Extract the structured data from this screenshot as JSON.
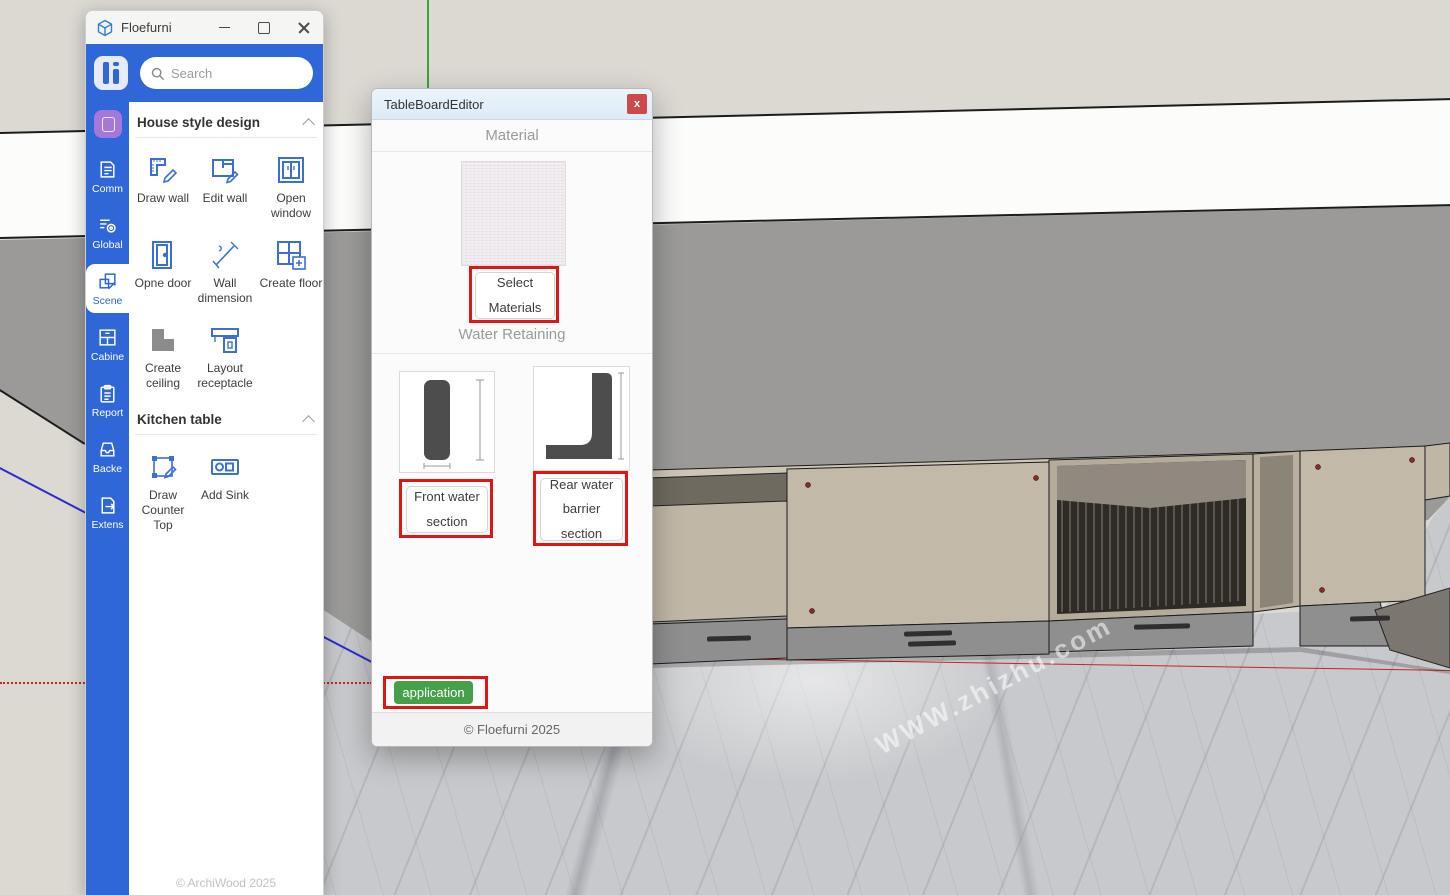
{
  "host_window": {
    "title": "Floefurni",
    "search_placeholder": "Search",
    "footer": "© ArchiWood 2025"
  },
  "rail": {
    "selected": "Scene",
    "items": [
      {
        "label": "Comm"
      },
      {
        "label": "Global"
      },
      {
        "label": "Scene"
      },
      {
        "label": "Cabine"
      },
      {
        "label": "Report"
      },
      {
        "label": "Backe"
      },
      {
        "label": "Extens"
      }
    ]
  },
  "panel": {
    "sections": [
      {
        "title": "House style design",
        "tools": [
          {
            "label": "Draw wall"
          },
          {
            "label": "Edit wall"
          },
          {
            "label": "Open window"
          },
          {
            "label": "Opne door"
          },
          {
            "label": "Wall dimension"
          },
          {
            "label": "Create floor"
          },
          {
            "label": "Create ceiling"
          },
          {
            "label": "Layout receptacle"
          }
        ]
      },
      {
        "title": "Kitchen table",
        "tools": [
          {
            "label": "Draw Counter Top"
          },
          {
            "label": "Add Sink"
          }
        ]
      }
    ]
  },
  "dialog": {
    "title": "TableBoardEditor",
    "close_label": "x",
    "material_heading": "Material",
    "select_materials_label": "Select\nMaterials",
    "water_heading": "Water Retaining",
    "front_option_label": "Front water\nsection",
    "rear_option_label": "Rear water\nbarrier\nsection",
    "apply_label": "application",
    "footer": "© Floefurni 2025"
  },
  "scene": {
    "watermark": "WWW.zhizhu.com"
  },
  "colors": {
    "accent_blue": "#2f66d8",
    "annotation_red": "#e01515",
    "apply_green": "#45a049",
    "axis_red": "#cc2222",
    "axis_green": "#3aa33a",
    "axis_blue": "#2b2bd0"
  }
}
